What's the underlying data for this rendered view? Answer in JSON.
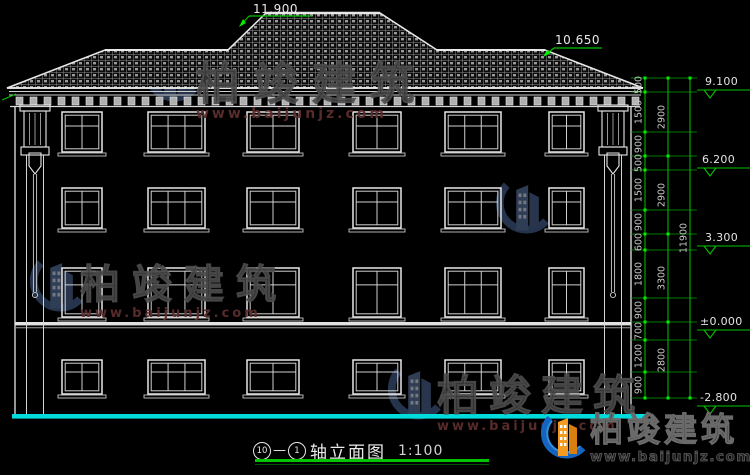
{
  "labels": {
    "ridge": "11.900",
    "side_ridge": "10.650"
  },
  "elevations": [
    "9.100",
    "6.200",
    "3.300",
    "±0.000",
    "-2.800"
  ],
  "dims": {
    "inner": [
      "500",
      "1500",
      "900",
      "500",
      "1500",
      "900",
      "600",
      "1800",
      "900",
      "700",
      "1200",
      "900"
    ],
    "middle": [
      "2900",
      "2900",
      "3300",
      "2800"
    ],
    "overall": [
      "11900"
    ]
  },
  "title": {
    "axis_start": "10",
    "separator": "—",
    "axis_end": "1",
    "name": "轴立面图",
    "scale": "1:100"
  },
  "watermark": {
    "brand": "柏竣建筑",
    "url": "www.baijunjz.com"
  },
  "colors": {
    "dim_green": "#00c400",
    "tick_green": "#00ee00",
    "ground_cyan": "#00dcdc",
    "line_white": "#e8e8e8"
  }
}
